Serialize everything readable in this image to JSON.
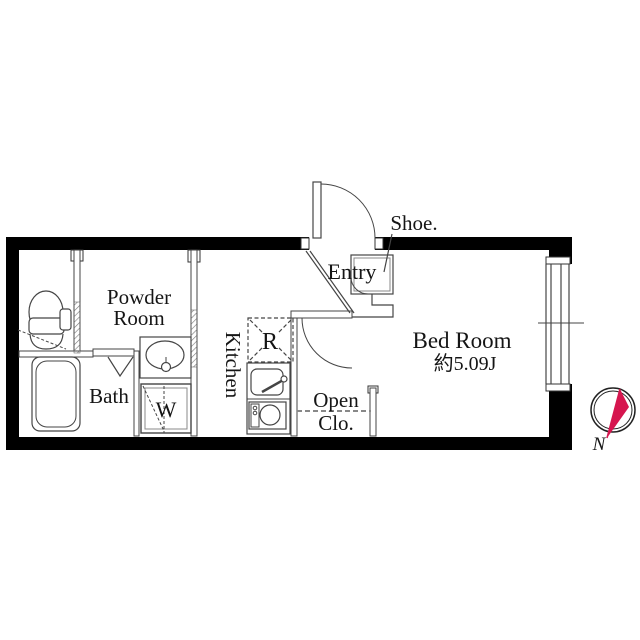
{
  "rooms": {
    "powder": {
      "line1": "Powder",
      "line2": "Room"
    },
    "bath": {
      "label": "Bath"
    },
    "kitchen": {
      "label": "Kitchen"
    },
    "entry": {
      "label": "Entry"
    },
    "bedroom": {
      "label": "Bed Room",
      "size": "約5.09J"
    },
    "open_closet": {
      "line1": "Open",
      "line2": "Clo."
    }
  },
  "fixtures": {
    "washer": "W",
    "refrigerator": "R",
    "shoe_cabinet": "Shoe."
  },
  "compass": {
    "north": "N"
  },
  "colors": {
    "wall": "#000000",
    "line": "#454545",
    "needle": "#d6164f"
  }
}
